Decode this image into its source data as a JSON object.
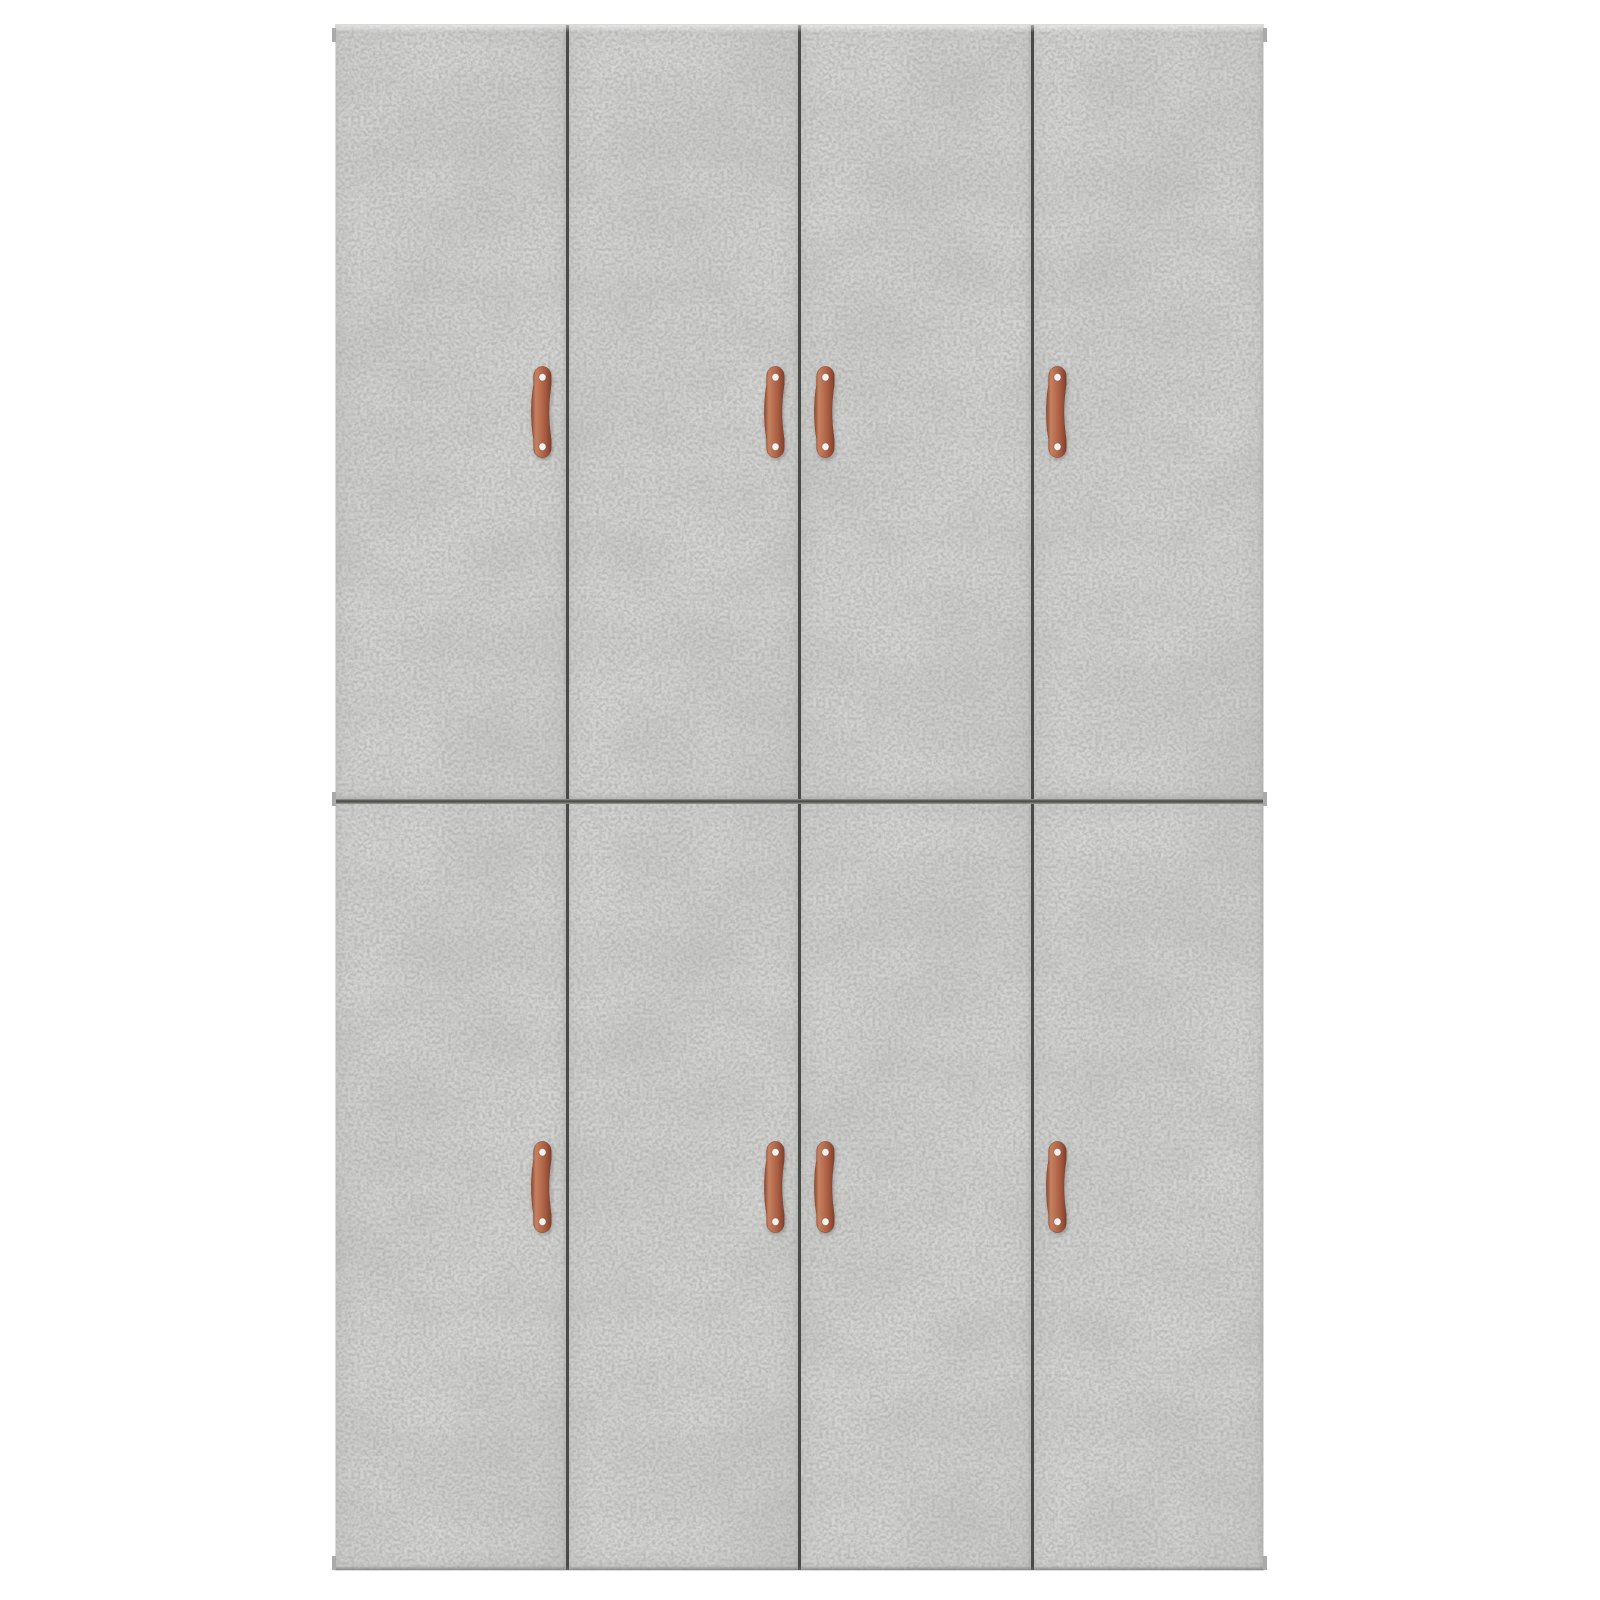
{
  "scene": {
    "description": "Product photo of a tall stacked cabinet in concrete-grey with eight doors and copper strap handles on a white background",
    "background_color": "#ffffff"
  },
  "cabinet": {
    "x": 336,
    "y": 25,
    "width": 927,
    "height": 1545,
    "door_base_color": "#d0d1cf",
    "door_speckle_color": "#9fa09e",
    "seam_color": "#4a4a48",
    "edge_tab_color": "#aaaba9",
    "mid_seam": {
      "y": 774,
      "height": 5
    },
    "doors_per_section": 4,
    "door_count_total": 8,
    "sections": [
      {
        "name": "upper",
        "y": 0,
        "height": 774,
        "handle_center_y": 387
      },
      {
        "name": "lower",
        "y": 779,
        "height": 766,
        "handle_center_y": 383
      }
    ],
    "handle_center_offsets_x": [
      206,
      439,
      489,
      721
    ],
    "handle": {
      "count": 8,
      "style": "copper strap pull with two screws",
      "color_light": "#cf8a6b",
      "color_main": "#b2664e",
      "color_dark": "#8a4a35",
      "color_edge": "#7a3b28",
      "screw_color": "#f2f2f0"
    },
    "edge_tabs": [
      {
        "side": "left",
        "y": 3
      },
      {
        "side": "left",
        "y": 767
      },
      {
        "side": "left",
        "y": 1531
      },
      {
        "side": "right",
        "y": 3
      },
      {
        "side": "right",
        "y": 767
      },
      {
        "side": "right",
        "y": 1531
      }
    ]
  }
}
